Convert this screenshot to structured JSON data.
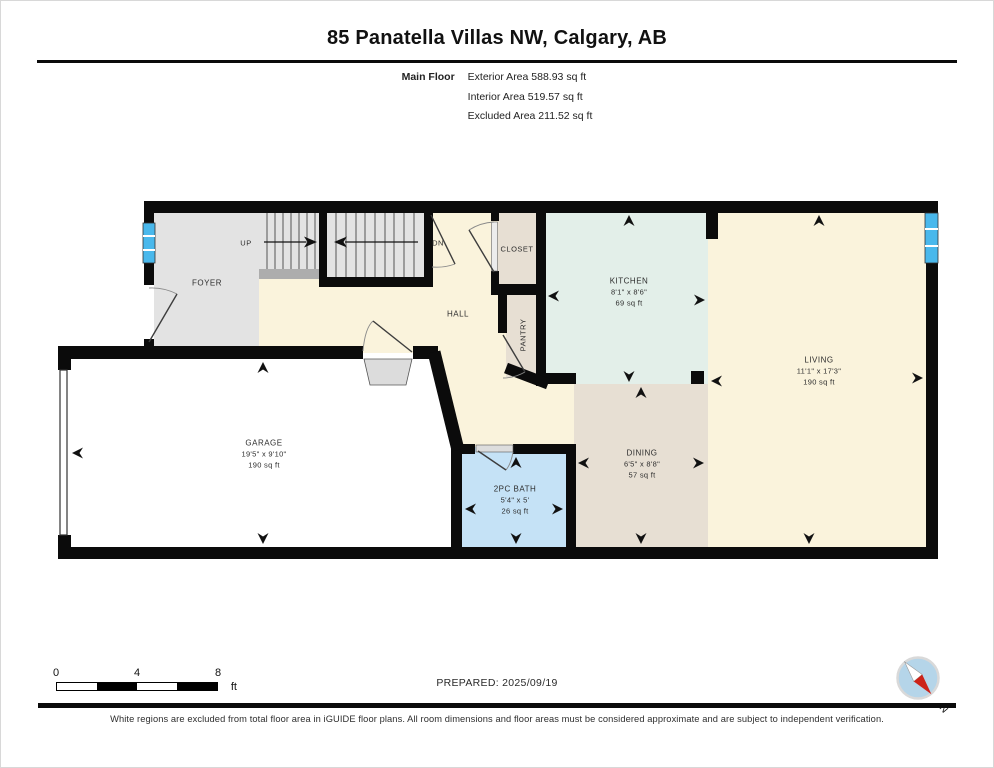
{
  "header": {
    "title": "85 Panatella Villas NW, Calgary, AB",
    "floor_label": "Main Floor",
    "stats": [
      "Exterior Area 588.93 sq ft",
      "Interior Area 519.57 sq ft",
      "Excluded Area 211.52 sq ft"
    ]
  },
  "rooms": {
    "foyer": {
      "name": "FOYER"
    },
    "hall": {
      "name": "HALL"
    },
    "closet": {
      "name": "CLOSET"
    },
    "pantry": {
      "name": "PANTRY"
    },
    "kitchen": {
      "name": "KITCHEN",
      "dims": "8'1\" x 8'6\"",
      "area": "69 sq ft"
    },
    "living": {
      "name": "LIVING",
      "dims": "11'1\" x 17'3\"",
      "area": "190 sq ft"
    },
    "dining": {
      "name": "DINING",
      "dims": "6'5\" x 8'8\"",
      "area": "57 sq ft"
    },
    "garage": {
      "name": "GARAGE",
      "dims": "19'5\" x 9'10\"",
      "area": "190 sq ft"
    },
    "bath": {
      "name": "2PC BATH",
      "dims": "5'4\" x 5'",
      "area": "26 sq ft"
    }
  },
  "stairs": {
    "up_label": "UP",
    "down_label": "DN"
  },
  "scale_bar": {
    "ticks": [
      "0",
      "4",
      "8"
    ],
    "unit": "ft"
  },
  "footer": {
    "prepared": "PREPARED: 2025/09/19",
    "disclaimer": "White regions are excluded from total floor area in iGUIDE floor plans. All room dimensions and floor areas must be considered approximate and are subject to independent verification.",
    "compass_label": "N"
  },
  "colors": {
    "wall": "#0b0b0b",
    "cream": "#faf3dc",
    "gray_room": "#e3e3e3",
    "beige": "#e7dfd3",
    "mint": "#e3efe9",
    "bath_blue": "#c5e2f6",
    "window_blue": "#49b8ec",
    "garage_white": "#ffffff",
    "compass_fill": "#b5d5e9",
    "compass_red": "#cc2218"
  }
}
